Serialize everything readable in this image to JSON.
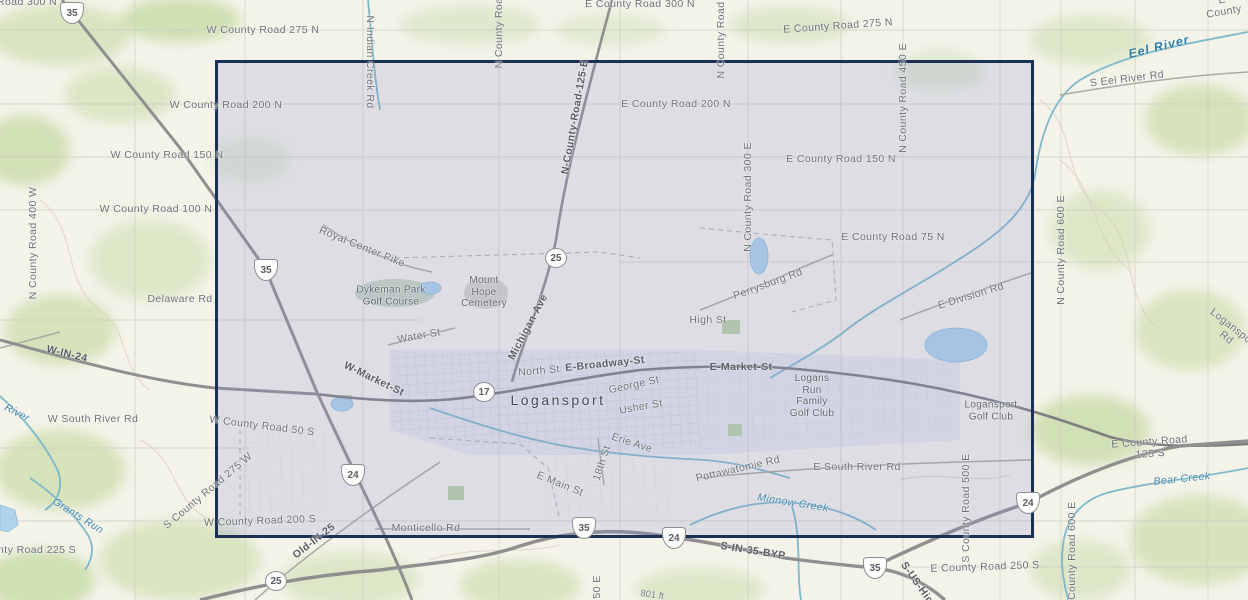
{
  "map": {
    "title": "Topographic street map of Logansport, Indiana with selection extent",
    "selection": {
      "x": 215,
      "y": 60,
      "width": 819,
      "height": 478,
      "border_color": "#1c2f55",
      "fill_color": "rgba(143,146,205,0.22)"
    },
    "colors": {
      "background": "#f4f3e9",
      "vegetation": "#d5e2ba",
      "water": "#7fb8c9",
      "road_major": "#8f8f8f",
      "road_minor": "#a9a9a5",
      "label_gray": "#6a7076",
      "label_water": "#3e84a8",
      "selection_border": "#1c2f55"
    },
    "labels": [
      {
        "name": "road-300-n-label",
        "text": "Road 300 N",
        "x": 27,
        "y": 2,
        "rot": 0,
        "cls": "lbl-road"
      },
      {
        "name": "e-county-road-300-n-label",
        "text": "E County Road 300 N",
        "x": 640,
        "y": 4,
        "rot": 0,
        "cls": "lbl-road"
      },
      {
        "name": "w-county-road-275-n-label",
        "text": "W County Road 275 N",
        "x": 263,
        "y": 30,
        "rot": 0,
        "cls": "lbl-road"
      },
      {
        "name": "e-county-road-275-n-label",
        "text": "E County Road 275 N",
        "x": 838,
        "y": 26,
        "rot": -4,
        "cls": "lbl-road"
      },
      {
        "name": "e-county-partial-label",
        "text": "E County",
        "x": 1223,
        "y": 6,
        "rot": -10,
        "cls": "lbl-road"
      },
      {
        "name": "eel-river-label",
        "text": "Eel River",
        "x": 1159,
        "y": 47,
        "rot": -14,
        "cls": "lbl-water-big"
      },
      {
        "name": "s-eel-river-rd-label",
        "text": "S Eel River Rd",
        "x": 1127,
        "y": 79,
        "rot": -7,
        "cls": "lbl-road"
      },
      {
        "name": "n-county-roa-vert1-label",
        "text": "N County Roa",
        "x": 499,
        "y": 33,
        "rot": -90,
        "cls": "lbl-road"
      },
      {
        "name": "n-county-road-vert2-label",
        "text": "N County Road",
        "x": 721,
        "y": 40,
        "rot": -90,
        "cls": "lbl-road"
      },
      {
        "name": "n-indian-creek-rd-label",
        "text": "N Indian Creek Rd",
        "x": 370,
        "y": 62,
        "rot": 90,
        "cls": "lbl-road"
      },
      {
        "name": "n-county-road-125-e-label",
        "text": "N-County-Road-125-E",
        "x": 575,
        "y": 117,
        "rot": -80,
        "cls": "lbl-bold"
      },
      {
        "name": "w-county-road-200-n-label",
        "text": "W County Road 200 N",
        "x": 226,
        "y": 105,
        "rot": 0,
        "cls": "lbl-road"
      },
      {
        "name": "e-county-road-200-n-label",
        "text": "E County Road 200 N",
        "x": 676,
        "y": 104,
        "rot": 0,
        "cls": "lbl-road"
      },
      {
        "name": "w-county-road-150-n-label",
        "text": "W County Road 150 N",
        "x": 167,
        "y": 155,
        "rot": 0,
        "cls": "lbl-road"
      },
      {
        "name": "e-county-road-150-n-label",
        "text": "E County Road 150 N",
        "x": 841,
        "y": 159,
        "rot": 0,
        "cls": "lbl-road"
      },
      {
        "name": "n-county-road-450-e-label",
        "text": "N County Road 450 E",
        "x": 903,
        "y": 98,
        "rot": -90,
        "cls": "lbl-road"
      },
      {
        "name": "w-county-road-100-n-label",
        "text": "W County Road 100 N",
        "x": 156,
        "y": 209,
        "rot": 0,
        "cls": "lbl-road"
      },
      {
        "name": "e-county-road-75-n-label",
        "text": "E County Road 75 N",
        "x": 893,
        "y": 237,
        "rot": 0,
        "cls": "lbl-road"
      },
      {
        "name": "n-county-road-300-e-label",
        "text": "N County Road 300 E",
        "x": 748,
        "y": 197,
        "rot": -90,
        "cls": "lbl-road"
      },
      {
        "name": "n-county-road-400-w-label",
        "text": "N County Road 400 W",
        "x": 33,
        "y": 243,
        "rot": -90,
        "cls": "lbl-road"
      },
      {
        "name": "n-county-road-600-e-label",
        "text": "N County Road 600 E",
        "x": 1061,
        "y": 250,
        "rot": -90,
        "cls": "lbl-road"
      },
      {
        "name": "delaware-rd-label",
        "text": "Delaware Rd",
        "x": 180,
        "y": 299,
        "rot": 0,
        "cls": "lbl-road"
      },
      {
        "name": "royal-center-pike-label",
        "text": "Royal Center Pike",
        "x": 362,
        "y": 247,
        "rot": 22,
        "cls": "lbl-road"
      },
      {
        "name": "perrysburg-rd-label",
        "text": "Perrysburg Rd",
        "x": 768,
        "y": 284,
        "rot": -20,
        "cls": "lbl-road"
      },
      {
        "name": "e-division-rd-label",
        "text": "E Division Rd",
        "x": 971,
        "y": 296,
        "rot": -17,
        "cls": "lbl-road"
      },
      {
        "name": "dykeman-park-golf-course-label",
        "text": "Dykeman Park\nGolf Course",
        "x": 391,
        "y": 296,
        "rot": 0,
        "cls": "lbl-place"
      },
      {
        "name": "mount-hope-cemetery-label",
        "text": "Mount\nHope\nCemetery",
        "x": 484,
        "y": 292,
        "rot": 0,
        "cls": "lbl-place"
      },
      {
        "name": "michigan-ave-label",
        "text": "Michigan-Ave",
        "x": 528,
        "y": 327,
        "rot": -62,
        "cls": "lbl-bold"
      },
      {
        "name": "high-st-label",
        "text": "High St",
        "x": 708,
        "y": 320,
        "rot": 0,
        "cls": "lbl-road"
      },
      {
        "name": "water-st-label",
        "text": "Water St",
        "x": 419,
        "y": 336,
        "rot": -10,
        "cls": "lbl-road"
      },
      {
        "name": "logansport-rd-label",
        "text": "Logansport Rd",
        "x": 1230,
        "y": 333,
        "rot": 38,
        "cls": "lbl-road"
      },
      {
        "name": "w-in-24-label",
        "text": "W-IN-24",
        "x": 67,
        "y": 354,
        "rot": 14,
        "cls": "lbl-bold"
      },
      {
        "name": "w-market-st-label",
        "text": "W-Market-St",
        "x": 374,
        "y": 379,
        "rot": 26,
        "cls": "lbl-bold"
      },
      {
        "name": "north-st-label",
        "text": "North St",
        "x": 539,
        "y": 371,
        "rot": -5,
        "cls": "lbl-road"
      },
      {
        "name": "e-broadway-st-label",
        "text": "E-Broadway-St",
        "x": 605,
        "y": 364,
        "rot": -6,
        "cls": "lbl-bold"
      },
      {
        "name": "e-market-st-label",
        "text": "E-Market-St",
        "x": 741,
        "y": 367,
        "rot": 0,
        "cls": "lbl-bold"
      },
      {
        "name": "george-st-label",
        "text": "George St",
        "x": 634,
        "y": 385,
        "rot": -12,
        "cls": "lbl-road"
      },
      {
        "name": "logansport-city-label",
        "text": "Logansport",
        "x": 558,
        "y": 400,
        "rot": 0,
        "cls": "lbl-city"
      },
      {
        "name": "usher-st-label",
        "text": "Usher St",
        "x": 641,
        "y": 407,
        "rot": -10,
        "cls": "lbl-road"
      },
      {
        "name": "w-south-river-rd-label",
        "text": "W South River Rd",
        "x": 93,
        "y": 419,
        "rot": 0,
        "cls": "lbl-road"
      },
      {
        "name": "river-label",
        "text": "River",
        "x": 17,
        "y": 413,
        "rot": 28,
        "cls": "lbl-water"
      },
      {
        "name": "w-county-road-50-s-label",
        "text": "W County Road 50 S",
        "x": 262,
        "y": 426,
        "rot": 7,
        "cls": "lbl-road"
      },
      {
        "name": "logans-run-family-golf-club-label",
        "text": "Logans\nRun\nFamily\nGolf Club",
        "x": 812,
        "y": 396,
        "rot": 0,
        "cls": "lbl-place"
      },
      {
        "name": "logansport-golf-club-label",
        "text": "Logansport\nGolf Club",
        "x": 991,
        "y": 411,
        "rot": 0,
        "cls": "lbl-place"
      },
      {
        "name": "erie-ave-label",
        "text": "Erie Ave",
        "x": 632,
        "y": 443,
        "rot": 18,
        "cls": "lbl-road"
      },
      {
        "name": "eighteenth-st-label",
        "text": "18th St",
        "x": 602,
        "y": 463,
        "rot": -72,
        "cls": "lbl-road"
      },
      {
        "name": "e-main-st-label",
        "text": "E Main St",
        "x": 560,
        "y": 484,
        "rot": 22,
        "cls": "lbl-road"
      },
      {
        "name": "pottawatomie-rd-label",
        "text": "Pottawatomie Rd",
        "x": 738,
        "y": 469,
        "rot": -13,
        "cls": "lbl-road"
      },
      {
        "name": "e-south-river-rd-label",
        "text": "E South River Rd",
        "x": 857,
        "y": 467,
        "rot": 0,
        "cls": "lbl-road"
      },
      {
        "name": "s-county-road-500-e-label",
        "text": "S County Road 500 E",
        "x": 966,
        "y": 508,
        "rot": -90,
        "cls": "lbl-road"
      },
      {
        "name": "e-county-road-125-s-label",
        "text": "E County Road 125 S",
        "x": 1150,
        "y": 448,
        "rot": -4,
        "cls": "lbl-road"
      },
      {
        "name": "bear-creek-label",
        "text": "Bear Creek",
        "x": 1182,
        "y": 479,
        "rot": -6,
        "cls": "lbl-water"
      },
      {
        "name": "minnow-creek-label",
        "text": "Minnow Creek",
        "x": 793,
        "y": 503,
        "rot": 9,
        "cls": "lbl-water"
      },
      {
        "name": "grants-run-label",
        "text": "Grants Run",
        "x": 78,
        "y": 516,
        "rot": 32,
        "cls": "lbl-water"
      },
      {
        "name": "s-county-road-275-w-label",
        "text": "S County Road 275 W",
        "x": 208,
        "y": 491,
        "rot": -40,
        "cls": "lbl-road"
      },
      {
        "name": "w-county-road-200-s-label",
        "text": "W County Road 200 S",
        "x": 260,
        "y": 521,
        "rot": -2,
        "cls": "lbl-road"
      },
      {
        "name": "monticello-rd-label",
        "text": "Monticello Rd",
        "x": 426,
        "y": 528,
        "rot": 0,
        "cls": "lbl-road"
      },
      {
        "name": "old-in-25-label",
        "text": "Old-IN-25",
        "x": 314,
        "y": 541,
        "rot": -38,
        "cls": "lbl-bold"
      },
      {
        "name": "s-in-35-byp-label",
        "text": "S-IN-35-BYP",
        "x": 753,
        "y": 551,
        "rot": 9,
        "cls": "lbl-bold"
      },
      {
        "name": "w-county-road-225-s-label",
        "text": "W County Road 225 S",
        "x": 20,
        "y": 550,
        "rot": 0,
        "cls": "lbl-road"
      },
      {
        "name": "e-county-road-250-s-label",
        "text": "E County Road 250 S",
        "x": 985,
        "y": 567,
        "rot": -2,
        "cls": "lbl-road"
      },
      {
        "name": "s-us-highway-label",
        "text": "S-US-Hig",
        "x": 917,
        "y": 583,
        "rot": 55,
        "cls": "lbl-bold"
      },
      {
        "name": "s-county-road-600-e-label",
        "text": "S County Road 600 E",
        "x": 1072,
        "y": 556,
        "rot": -90,
        "cls": "lbl-road"
      },
      {
        "name": "s-county-road-450-e-partial-label",
        "text": "50 E",
        "x": 597,
        "y": 587,
        "rot": -90,
        "cls": "lbl-road"
      },
      {
        "name": "elevation-801-ft-label",
        "text": "801 ft",
        "x": 652,
        "y": 596,
        "rot": 8,
        "cls": "lbl-small"
      }
    ],
    "shields": [
      {
        "name": "us-35-shield-nw",
        "type": "us",
        "num": "35",
        "x": 72,
        "y": 13
      },
      {
        "name": "us-35-shield-west",
        "type": "us",
        "num": "35",
        "x": 266,
        "y": 270
      },
      {
        "name": "in-25-shield-north",
        "type": "state",
        "num": "25",
        "x": 556,
        "y": 258
      },
      {
        "name": "in-17-shield",
        "type": "state",
        "num": "17",
        "x": 484,
        "y": 392
      },
      {
        "name": "us-24-shield-city",
        "type": "us",
        "num": "24",
        "x": 353,
        "y": 475
      },
      {
        "name": "in-25-shield-south",
        "type": "state",
        "num": "25",
        "x": 276,
        "y": 581
      },
      {
        "name": "us-35-shield-bypass",
        "type": "us",
        "num": "35",
        "x": 584,
        "y": 528
      },
      {
        "name": "us-24-shield-bypass",
        "type": "us",
        "num": "24",
        "x": 674,
        "y": 538
      },
      {
        "name": "us-35-shield-se",
        "type": "us",
        "num": "35",
        "x": 875,
        "y": 568
      },
      {
        "name": "us-24-shield-east",
        "type": "us",
        "num": "24",
        "x": 1028,
        "y": 503
      }
    ]
  }
}
